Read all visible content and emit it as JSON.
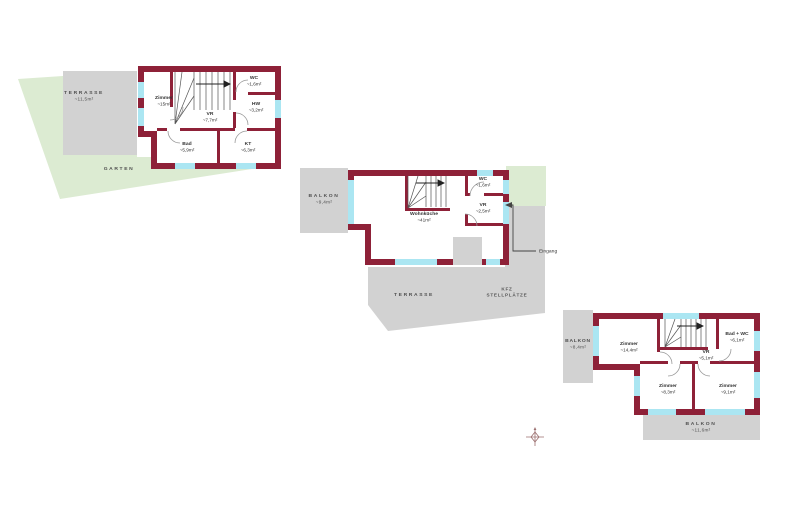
{
  "colors": {
    "wall": "#8e2138",
    "window": "#abe6f2",
    "outdoor_gray": "#d2d2d2",
    "garden_green": "#dcebd2"
  },
  "plan_a": {
    "rooms": {
      "zimmer": {
        "name": "Zimmer",
        "area": "~15m²"
      },
      "wc": {
        "name": "WC",
        "area": "~1,6m²"
      },
      "hw": {
        "name": "HW",
        "area": "~3,2m²"
      },
      "vr": {
        "name": "VR",
        "area": "~7,7m²"
      },
      "bad": {
        "name": "Bad",
        "area": "~5,9m²"
      },
      "kt": {
        "name": "KT",
        "area": "~6,3m²"
      }
    },
    "outdoor": {
      "terrasse": {
        "label": "TERRASSE",
        "area": "~11,5m²"
      },
      "garten": {
        "label": "GARTEN"
      }
    }
  },
  "plan_b": {
    "rooms": {
      "wohnkueche": {
        "name": "Wohnküche",
        "area": "~41m²"
      },
      "wc": {
        "name": "WC",
        "area": "~1,6m²"
      },
      "vr": {
        "name": "VR",
        "area": "~2,5m²"
      }
    },
    "outdoor": {
      "balkon": {
        "label": "BALKON",
        "area": "~9,4m²"
      },
      "terrasse": {
        "label": "TERRASSE"
      },
      "kfz": {
        "label": "KFZ",
        "sublabel": "STELLPLÄTZE"
      }
    },
    "entrance": {
      "label": "Eingang"
    }
  },
  "plan_c": {
    "rooms": {
      "zimmer_gross": {
        "name": "Zimmer",
        "area": "~14,4m²"
      },
      "bad_wc": {
        "name": "Bad + WC",
        "area": "~6,1m²"
      },
      "vr": {
        "name": "VR",
        "area": "~5,1m²"
      },
      "zimmer_sw": {
        "name": "Zimmer",
        "area": "~8,3m²"
      },
      "zimmer_so": {
        "name": "Zimmer",
        "area": "~9,1m²"
      }
    },
    "outdoor": {
      "balkon_west": {
        "label": "BALKON",
        "area": "~8,4m²"
      },
      "balkon_sued": {
        "label": "BALKON",
        "area": "~11,6m²"
      }
    }
  }
}
